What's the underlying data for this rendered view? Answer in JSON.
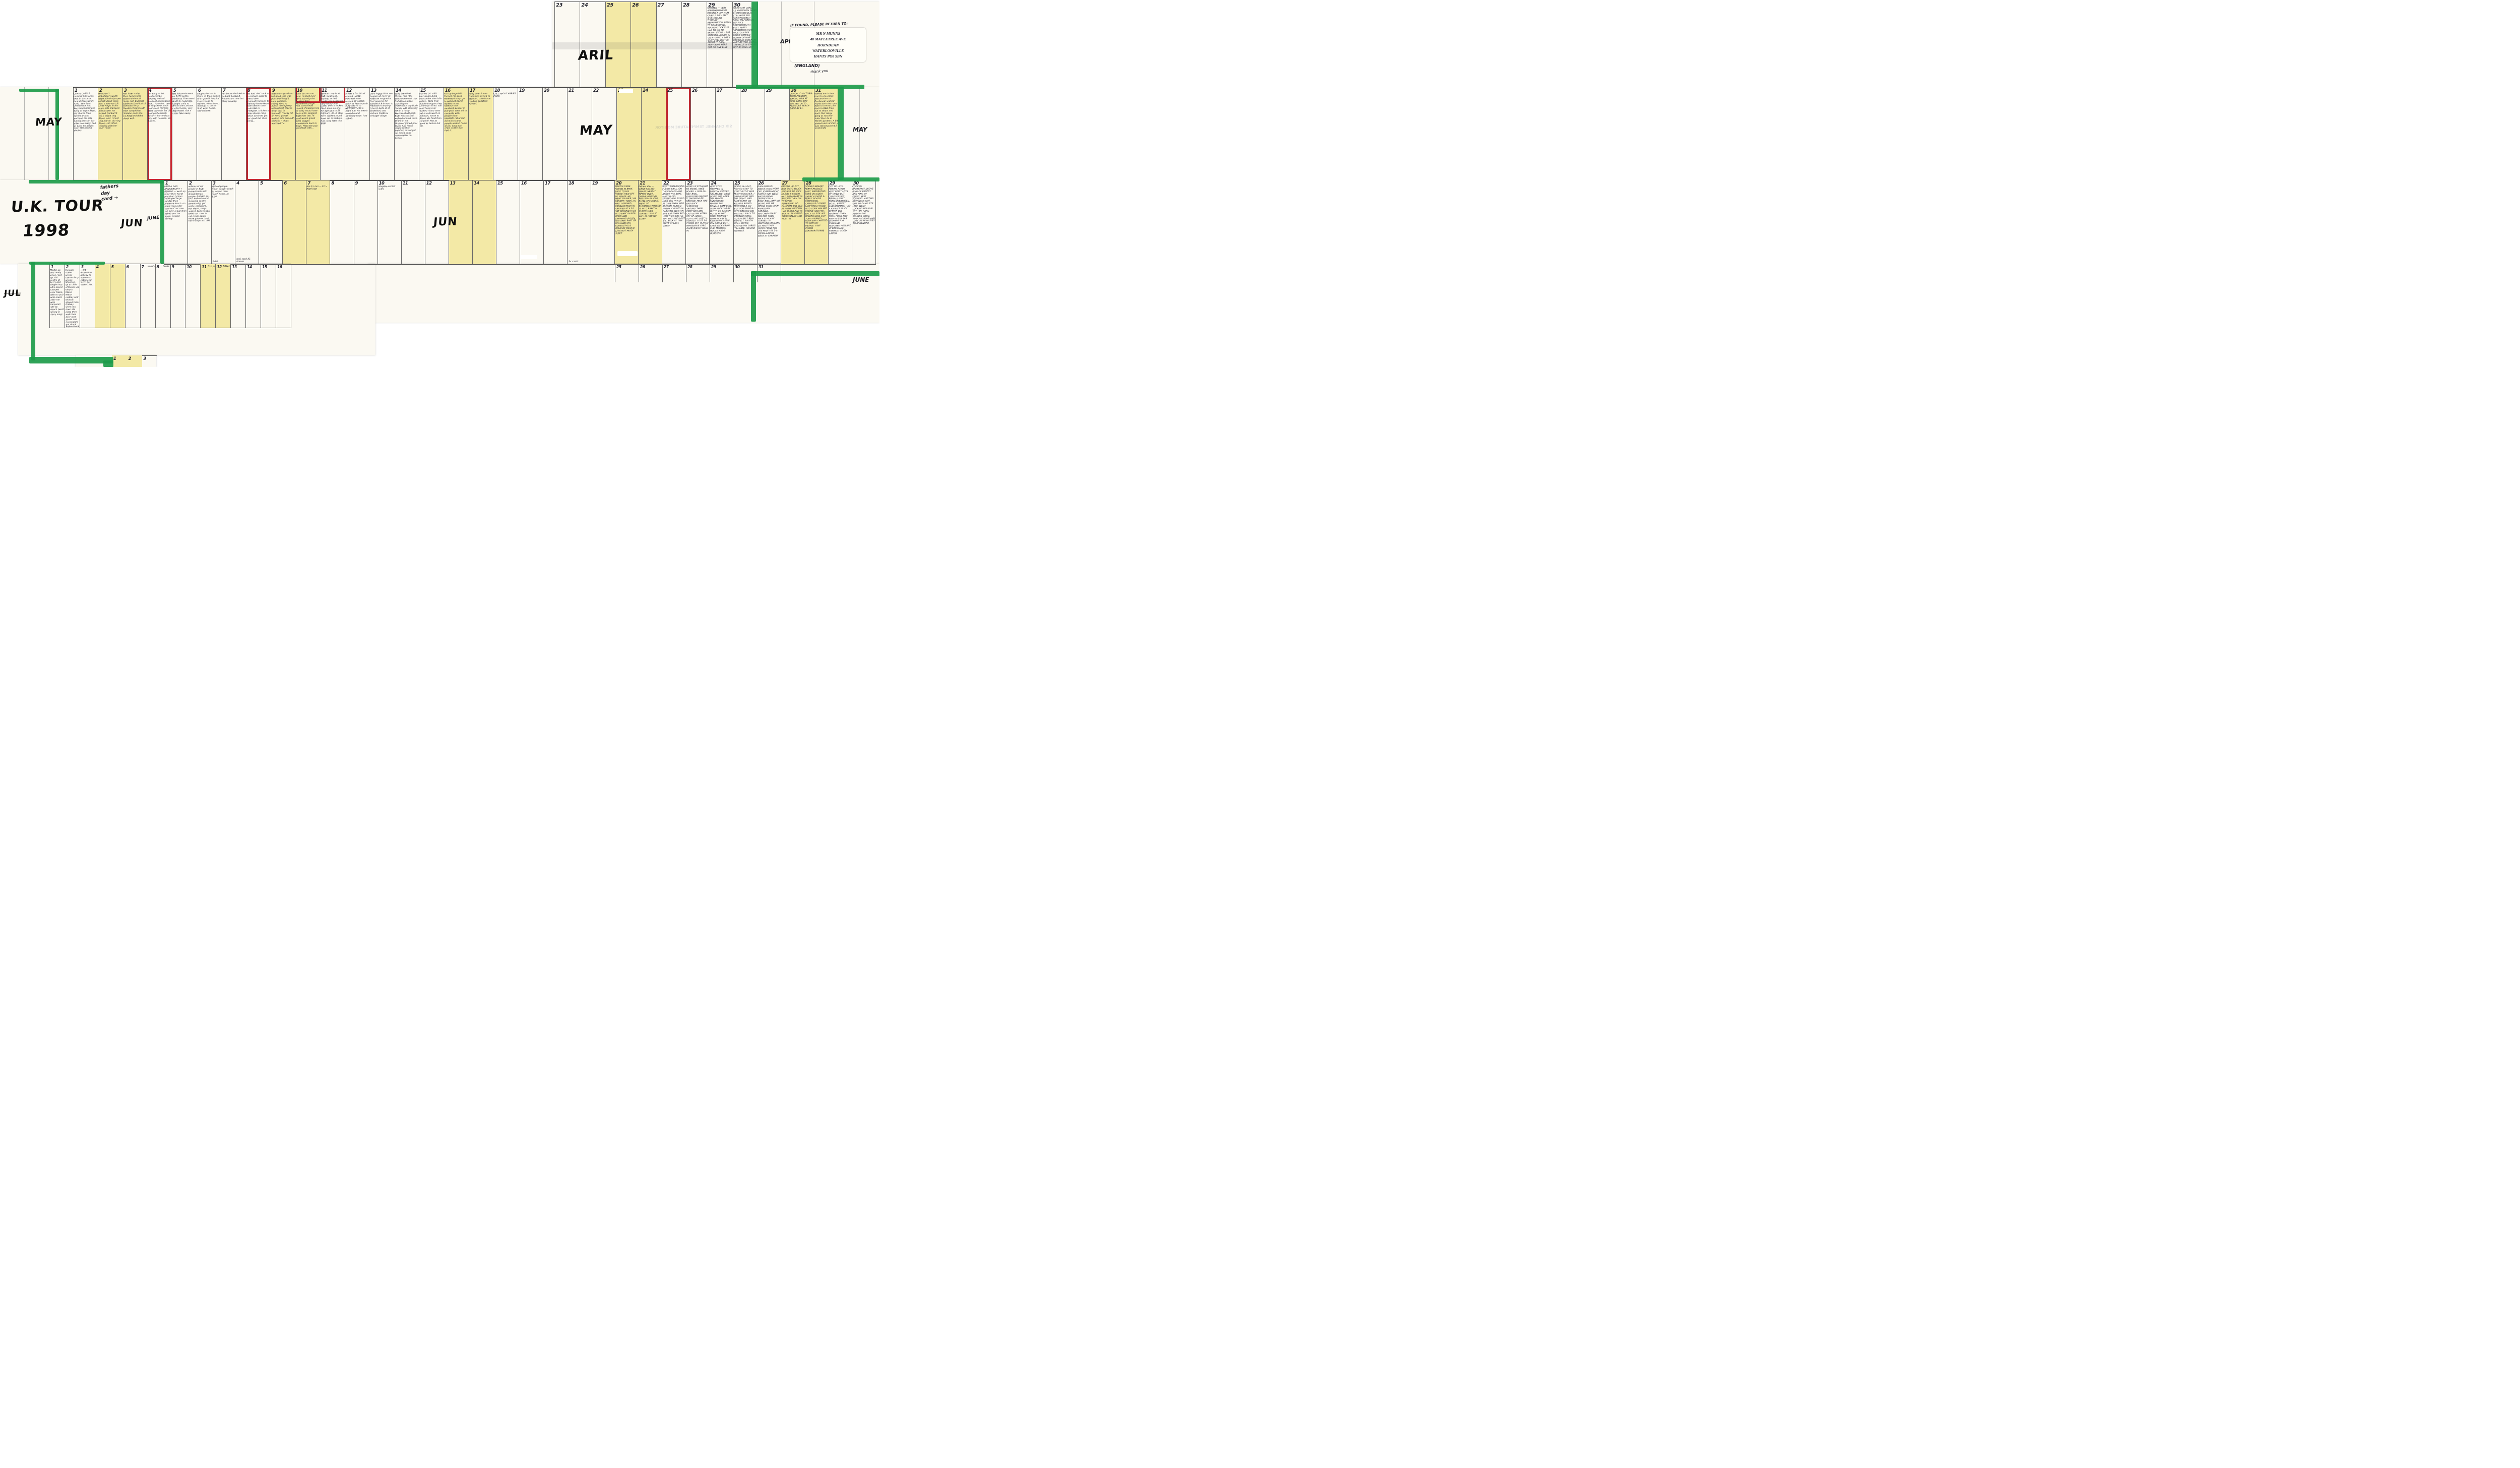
{
  "title": "U.K. TOUR 1998 hand-written wall planner",
  "colors": {
    "weekend_highlight": "#f3e9a6",
    "marker_green": "#1d9b4a",
    "marker_red": "#c2272f",
    "ink": "#23232e",
    "paper": "#fbf9f2"
  },
  "labels": {
    "uk_tour_line1": "U.K. TOUR",
    "uk_tour_line2": "1998",
    "april_big": "ARIL",
    "april_side": "APRIL",
    "may_big": "MAY",
    "may_left": "MAY",
    "may_side": "MAY",
    "jun_big": "JUN",
    "jun_next": "JUNE",
    "june_side": "JUNE",
    "jul": "JUL",
    "fathers_note": "fathers\nday\ncard  →"
  },
  "return_note": {
    "heading": "IF FOUND, PLEASE RETURN TO:",
    "address_lines": [
      "MR N MUNNS",
      "40 MAPLETREE AVE",
      "HORNDEAN",
      "WATERLOOVILLE",
      "HANTS PO8 9BN"
    ],
    "country": "(ENGLAND)",
    "thanks": "thank you"
  },
  "ghost_text": "SIX CHANNEL TEMPERATURE MONITOR",
  "rows": {
    "april": {
      "days": [
        {
          "n": "23",
          "text": ""
        },
        {
          "n": "24",
          "text": ""
        },
        {
          "n": "25",
          "text": "",
          "we": true
        },
        {
          "n": "26",
          "text": "",
          "we": true
        },
        {
          "n": "27",
          "text": ""
        },
        {
          "n": "28",
          "text": ""
        },
        {
          "n": "29",
          "text": "STARTED — VERY APPREHENSIVE RE PACKED A LOT MUM CRIED A BIT. I FELT SHIT. CYCLED THROUGH BEDHAMPTON. FERRY TO FISHBOURNE. ROUND CLOCKWISE. HAD TO GO TO BRIGHTSTONE. LEGS KNACKED. ALISON IS ON MY MIND A LOT. I MUST FEEL BETTER ABOUT IT. RAIN. ARMY BOYS HERE BUT NO ONE ELSE"
        },
        {
          "n": "30",
          "text": "CRIED SHIT LOADS. ILE YARMOUTH FERRY £1 PASS NEEDLES STILL HAVE FLU. CHRISTCHURCH ROSH MILFORD ON SEA NICE BOURNEMOUTH BUSY. FERRY SANDBANKS VERY NICE. CAN SEE POOLE CAMPED NORTH OF NINE BARROWS DOWN. IM A BIT BETTER. DOING THE HILLS IN STAGES NOT AS ONE LUMP"
        }
      ]
    },
    "may": {
      "days": [
        {
          "n": "1",
          "text": "CORFE CASTLE purbeck hills Army shut in bastards. long detour. windy A352. Sea front Overcombe into Weymouth Camped early at Wyke Regis, did chores then cycled around portland bill. late eating beers in bar after. too many. bed at 1am. Im alright now. Still having doubts."
        },
        {
          "n": "2",
          "we": true,
          "text": "HARD DAY. Abbotsbury worth large hill windy open hills Bridport more hills. Charmouth & Lyme Regis fuckin huge hills. Camped at Rousden. Im fucked. Sunburnt too. I might ring Alison later. I must ring martin. did ring Alison. still offish, relaxing with her mum more."
        },
        {
          "n": "3",
          "we": true,
          "text": "Felt fitter today. More fuckin hills, seaton sidmouth (large hill) Budleigh salterton (had lunch) exmouth ferry, Dawlish Teignmouth then camped by Shaldon posh site £1.80/grand didnt sleep well."
        },
        {
          "n": "4",
          "red": true,
          "text": "left early at 10, babbacombe torquay walked seafront horrendous hills. I hate this. beer at Kingswear lunch past stoke Fleming start bay only flat bit east portlemouth Ferry — horrendous site with no shop. Im fucked."
        },
        {
          "n": "5",
          "text": "left Salcombe went on A379 got to Modbury. Then went North to Ivybridge. Caught train to Bristol the Cosham. cycled home, very depressed. fish n chips take away."
        },
        {
          "n": "6",
          "text": "caught the bus to Cams rd then walked to ST JAMES hospital. I have to go to Havant. went there. I must go to doctor first. went home. had chinese."
        },
        {
          "n": "7",
          "text": "felt better decided to go back & b&b it. Not so sure now but Ill try anyway."
        },
        {
          "n": "8",
          "red": true,
          "text": "felt bad 'dad' took us to cosham. back to bristol then plymouth torpoint to anthony Rame Head down devon then posh b&b in undegate. chicken n chips dinner rang alison 20 times got her. good but shes going…"
        },
        {
          "n": "9",
          "we": true,
          "text": "Alison was good so I felt good (she was plastered laugh). Looe polperro. Fowey ferry. st Austal mevagissey hills hills ST Mawes ferry. b&b in falmouth (rowdy lot on ferry, great) walked into falmouth had cod n chips watched TV."
        },
        {
          "n": "10",
          "we": true,
          "rednum": true,
          "text": "RAIN but not too long. Helford river ferry. Lizard point helston then Porthleven (huge hill) st micheals mount. Penzance Isle of scilly would have been £50. smallest B&B ever (No TV cant watch grand prix) bugger. mousehole back to town. Pizza the pub good talk with…"
        },
        {
          "n": "11",
          "rednum": true,
          "text": "german couple at B&B. lands end. touristy as hell, roads very peacefull very windy after L.END then it looked liked spain no one for ages got to ST IVES at 1.30. Ill stop here. walked round town sat in harbour. had curry later nice B&B."
        },
        {
          "n": "12",
          "text": "at last a flat bit all around HAYLE. Portreath nice missed ST AGNES lunch at Perranporth. busy A3075 to NEWQUAY £10 a night B.B! No towels looked round Newquay town. had kebab."
        },
        {
          "n": "13",
          "text": "Ultra foggy didnt see buggar all. ferry at Padstow stopped at Port gaverne for sandwich B.B next to Headland camping. (church bells at st endellion) saw Arthurs Castle & Tintagel village"
        },
        {
          "n": "14",
          "text": "early breakfast. Mental hills FOG everywhere shit day. Got Alison letter. Crackington widemouth bay Bude (lunch) A39 clovelley left in a hurry Westward HO posh B&B. Im knacked. walked around town. Drank in the Dreamer joined pool team. had fish n chips went to bideford in taxi got rat arsed. read Alison letter on beach"
        },
        {
          "n": "15",
          "text": "started OK. A39 barnstable A361 Ilfracombe then hills galore. 1106 ft at blackmore gate then Lynmouth Tired. still a bit hung over walked round town sat in cafe went on hill train, wrote to Alison ate food then rung her. Not as good as before but OK."
        },
        {
          "n": "16",
          "we": true,
          "text": "FA cup huge hills Porlock hill good Minehead busy. got to watchet 1230! walked round harbour had sandwich & beer in pub pool. went off to campsite with people from HAVANT! rat arsed went into camp people walked home drunk. long way. chips on the way. Paid it."
        },
        {
          "n": "17",
          "we": true,
          "text": "hung over Steam train then cycled to taunton. train home reading guildford havant."
        },
        {
          "n": "18",
          "text": "CALL ABOUT ABBIES CARD"
        },
        {
          "n": "19",
          "text": ""
        },
        {
          "n": "20",
          "text": ""
        },
        {
          "n": "21",
          "text": ""
        },
        {
          "n": "22",
          "text": ""
        },
        {
          "n": "23",
          "we": true,
          "text": ""
        },
        {
          "n": "24",
          "we": true,
          "text": ""
        },
        {
          "n": "25",
          "red": true,
          "text": ""
        },
        {
          "n": "26",
          "text": ""
        },
        {
          "n": "27",
          "text": ""
        },
        {
          "n": "28",
          "text": ""
        },
        {
          "n": "29",
          "text": ""
        },
        {
          "n": "30",
          "we": true,
          "text": "COACH TO VICTORIA THEN PRESTON B/POOL. B&B AT 9ISH. LONG DAY WALKED UP TO PLEASURE BEACH BACK BY 11."
        },
        {
          "n": "31",
          "we": true,
          "text": "walked north then tram to cleveleys and another to fleetwood. walked round both the tram back to central pier. back to B&B then out to shops and back. Met rob & gang at sutcliffe hotel then do at Winter gardens. A bit pissed back at 2am. I was starving (sent 2 postcards)"
        }
      ]
    },
    "june": {
      "days": [
        {
          "n": "1",
          "text": "MUM & DAD ANNIVERSARY + REMIND — went up tower then North pier then lytham south pier large sundae then pleasure beach. on pepsi max roller coaster Cool. saw rob later in bar then kebab and bar again. ireland holiday"
        },
        {
          "n": "2",
          "text": "millions of old people in B&B. shared table with draughtsman couple. RAINED ALL DAY. walked round shopping centre (eventually) got pasty, cashpoint, bus depot, mags. soaked back to B&B dried out. over to rob in bar again. more guiness. had fish n chips at 1 AM."
        },
        {
          "n": "3",
          "text": "still old people there. caught coach to london then coach home. at 8.30.",
          "foot": "Ads?"
        },
        {
          "n": "4",
          "text": "",
          "foot": "toni card A1 horses"
        },
        {
          "n": "5",
          "text": ""
        },
        {
          "n": "6",
          "we": true,
          "text": ""
        },
        {
          "n": "7",
          "we": true,
          "text": "Alis 1½ hrs — F1 ↳ INDY CAR"
        },
        {
          "n": "8",
          "text": ""
        },
        {
          "n": "9",
          "text": ""
        },
        {
          "n": "10",
          "text": "(illegible circled note)"
        },
        {
          "n": "11",
          "text": ""
        },
        {
          "n": "12",
          "text": ""
        },
        {
          "n": "13",
          "we": true,
          "text": ""
        },
        {
          "n": "14",
          "we": true,
          "text": ""
        },
        {
          "n": "15",
          "text": ""
        },
        {
          "n": "16",
          "text": ""
        },
        {
          "n": "17",
          "text": ""
        },
        {
          "n": "18",
          "text": "",
          "foot": "2x cards"
        },
        {
          "n": "19",
          "text": ""
        },
        {
          "n": "20",
          "we": true,
          "text": "MARTIN CAME ROUND IN BMW. BACK TO HIS HOUSE THEN OFF TO WALES. HE WENT ON BIKE, VIA CARDIFF. TOOK 3¾ HRS. I OPENED CARAVAN MARTIN ARRIVED AT 4.30. SAT AROUND THEN INTO BRECON FOR GRUB AND SHOPPING (FOOD) WATCHED PART OF HOLLAND STH KOREA (5-0) & BELGIUM MEXICO (2-0) NOT MUCH SLEEP"
        },
        {
          "n": "21",
          "we": true,
          "text": "fathers day — WENT SAILING SMART. NEARLY TIPPED OVER. DROVE AROUND WYE VALLEY. CAR BLEW UP FIXED IT. WENT TO BLORENGE WALKED IT. INTO BRECON CURRY. MICK TURNED UP 4.30 AM!! ID HAD NO SLEEP"
        },
        {
          "n": "22",
          "text": "WENT WATERSKIING FUCKIN BRILL. ON THEM LOADS AND ABOVE THE BOAT, MARTIN DID KNEEBOARD AS DID MICK. BIG FRY UP AT CAFE THEN INTO BRECON. PLAYED FRISBY. CHILLED IN CARAVAN. WENT IN SITE BAR THEN RED LION THEN CASTLE INN. ENGLAND LOST 2-1. BACK AT 1AM SLEPT AT LAST, GREAT"
        },
        {
          "n": "23",
          "text": "WOKE UP STRAIGHT TO SKIING. KNEE BOARD + SKIS ALL DAY. BRILL EVERYONE ENJOYED IT, SHOPPING IN BRECON. MICK HAS BAD BACK. SLOUCHED AROUND THEN CAMP BAR AND CASTLE INN AFTER FRY UP LUNCH. SCOTLAND LOST 3-0 BRAZIL COST 2-1. PISSED OFF. PLAYED IMPOSSIBLE CARD GAME DID MY HEAD IN"
        },
        {
          "n": "24",
          "text": "VERY STIFF. SHOPPED IN BRECON MENDED INFLATABLE. WENT SKIING FOR AGES. DID 360 ON KNEEBOARD. MARTIN DID DONALD CAMPBELL. TOOK MICK CURRY. OUT THEN BEER IN HOTEL PLAYED POOL THEN MET WITH HILARY & KELVIN IN CASTLE INN DROVE BOTH CARS BACK FROM PUB. MARTINS HOUSE MADE BURGERS"
        },
        {
          "n": "25",
          "text": "SKIING ALL DAY. NOT SO STIFF TO START BUT IT WAS MUCH ROUGHER. I DROVE BOAT AND DID GREAT. HAD FACE PLANT ON KELVINS BOARD. MICK HAD A GO BUT TOO PAINFULL. INTO BRECON DID FUCKALL. BACK TO CARAVAN RANG ALISON FELT BRILL. PERFECT. BACON ROLL. DOWN CASTLE INN CARDS TILL LATE. I DRANK GUINESS."
        },
        {
          "n": "26",
          "text": "RAIN BOSSED ABOUT. MICK WENT OFF. JOINED HIM AT CASTLE INN. WENT WATERSKIING DROVE CAR + BOAT. BRILLIANT NO SKIING FOR ME MESSA COOL EVEN PARKED BY CARAVAN. WATCHED FERRY DID BBQ FOOD MICK & HILARY TURNED UP. WATCHED ENGLAND 1st HALF THEN QUICK POINT PUB 2nd HALF YES 2-0. MESSA LAUGH BACK AT CARAVAN"
        },
        {
          "n": "27",
          "we": true,
          "text": "PACKED UP. PUT BIKE ONTO TRUCK SAID BYE TO MICK HILARY & KELVIN. HAD BREAKFAST IN BRECON THEN ON TO FERRY PEMBROKE. NO CAMPSITE DID B&B AT ARTHURSTOWN HAD QUICK PINT IN BAR AFTER EATING ROLLS SALAD AND RICE TIN."
        },
        {
          "n": "28",
          "we": true,
          "text": "COOKED BREAKY. FERRY PASSAGE EAST, WATERFORD CORK VIA COBH CHURCH CHOIR & FERRY. ROADS CONFUSING. CAMPSITE COOKED LAST FRESH FOOD. INTO CORK WALKED ROUND HAD PINT. BACK TO SITE. HIS DRIVING WAS SHIT TODAY NIPPED OVER BAR CHATTED TO LOTS OF PEOPLE. A BIT PISSED (ARTHURSTOWN)"
        },
        {
          "n": "29",
          "text": "GOT UP LATE. MARTIN READY VERY RAINY LOTS OF VIEWS BUT CRAP VISUALS KINSALE FIRST THEN SKIBBEREEN, SKULL, BANTRY AND KENMARE HAD A KIP FELT MUCH BETTER DID WASHING THEN POSH FOOD AND PINT IN PUB BAR LOOKING FOR ENGLAND. WATCHED HOLLAND IN BAR MADE FRIENDS. GOOD LAUGH"
        },
        {
          "n": "30",
          "text": "COOKED BREAKFAST DROVE RING OF BANTRY AND RING OF KERRY. BEST SCENERY. MARTINS DRIVING IS SHIT. GOT TO CAMP SITE LATE. WENT LOOKING FOR PUB WITH TV. RANG ALISON SHE SOUNDS GOOD. WATCHED ENGLAND LOSE ON PENALTIES TO ARGENTINA"
        }
      ]
    },
    "june_subrow_numbers": [
      "25",
      "26",
      "27",
      "28",
      "29",
      "30",
      "31"
    ],
    "july": {
      "days": [
        {
          "n": "1",
          "text": "Martin up and ready when I got up. did centre of kerry and dingle loop. ultra scenic camped near tralee. went to pub with music after me with kareoke!! site by beach (went wrong in kerry loop)"
        },
        {
          "n": "2",
          "text": "through Tralee across canton ferry across Shannon. up to cliffs of Moher via Kilrush Kilkee Milton malbay and lehinch. stayed then Galway. went into town ate pizza then walk then beer met yanks and norwegians got drunk walked back got lost"
        },
        {
          "n": "3",
          "text": "—1/4— drove from galway to home via catameran ferry. got home 1AM."
        },
        {
          "n": "4",
          "we": true,
          "text": ""
        },
        {
          "n": "5",
          "we": true,
          "text": ""
        },
        {
          "n": "6",
          "text": ""
        },
        {
          "n": "7",
          "suffix": "semi —",
          "text": ""
        },
        {
          "n": "8",
          "suffix": "finals —",
          "text": ""
        },
        {
          "n": "9",
          "text": ""
        },
        {
          "n": "10",
          "text": ""
        },
        {
          "n": "11",
          "we": true,
          "suffix": "3rd place",
          "text": ""
        },
        {
          "n": "12",
          "we": true,
          "suffix": "FINAL",
          "text": ""
        },
        {
          "n": "13",
          "text": ""
        },
        {
          "n": "14",
          "text": ""
        },
        {
          "n": "15",
          "text": ""
        },
        {
          "n": "16",
          "text": ""
        }
      ]
    },
    "august_partial_numbers": [
      "1",
      "2",
      "3"
    ]
  }
}
